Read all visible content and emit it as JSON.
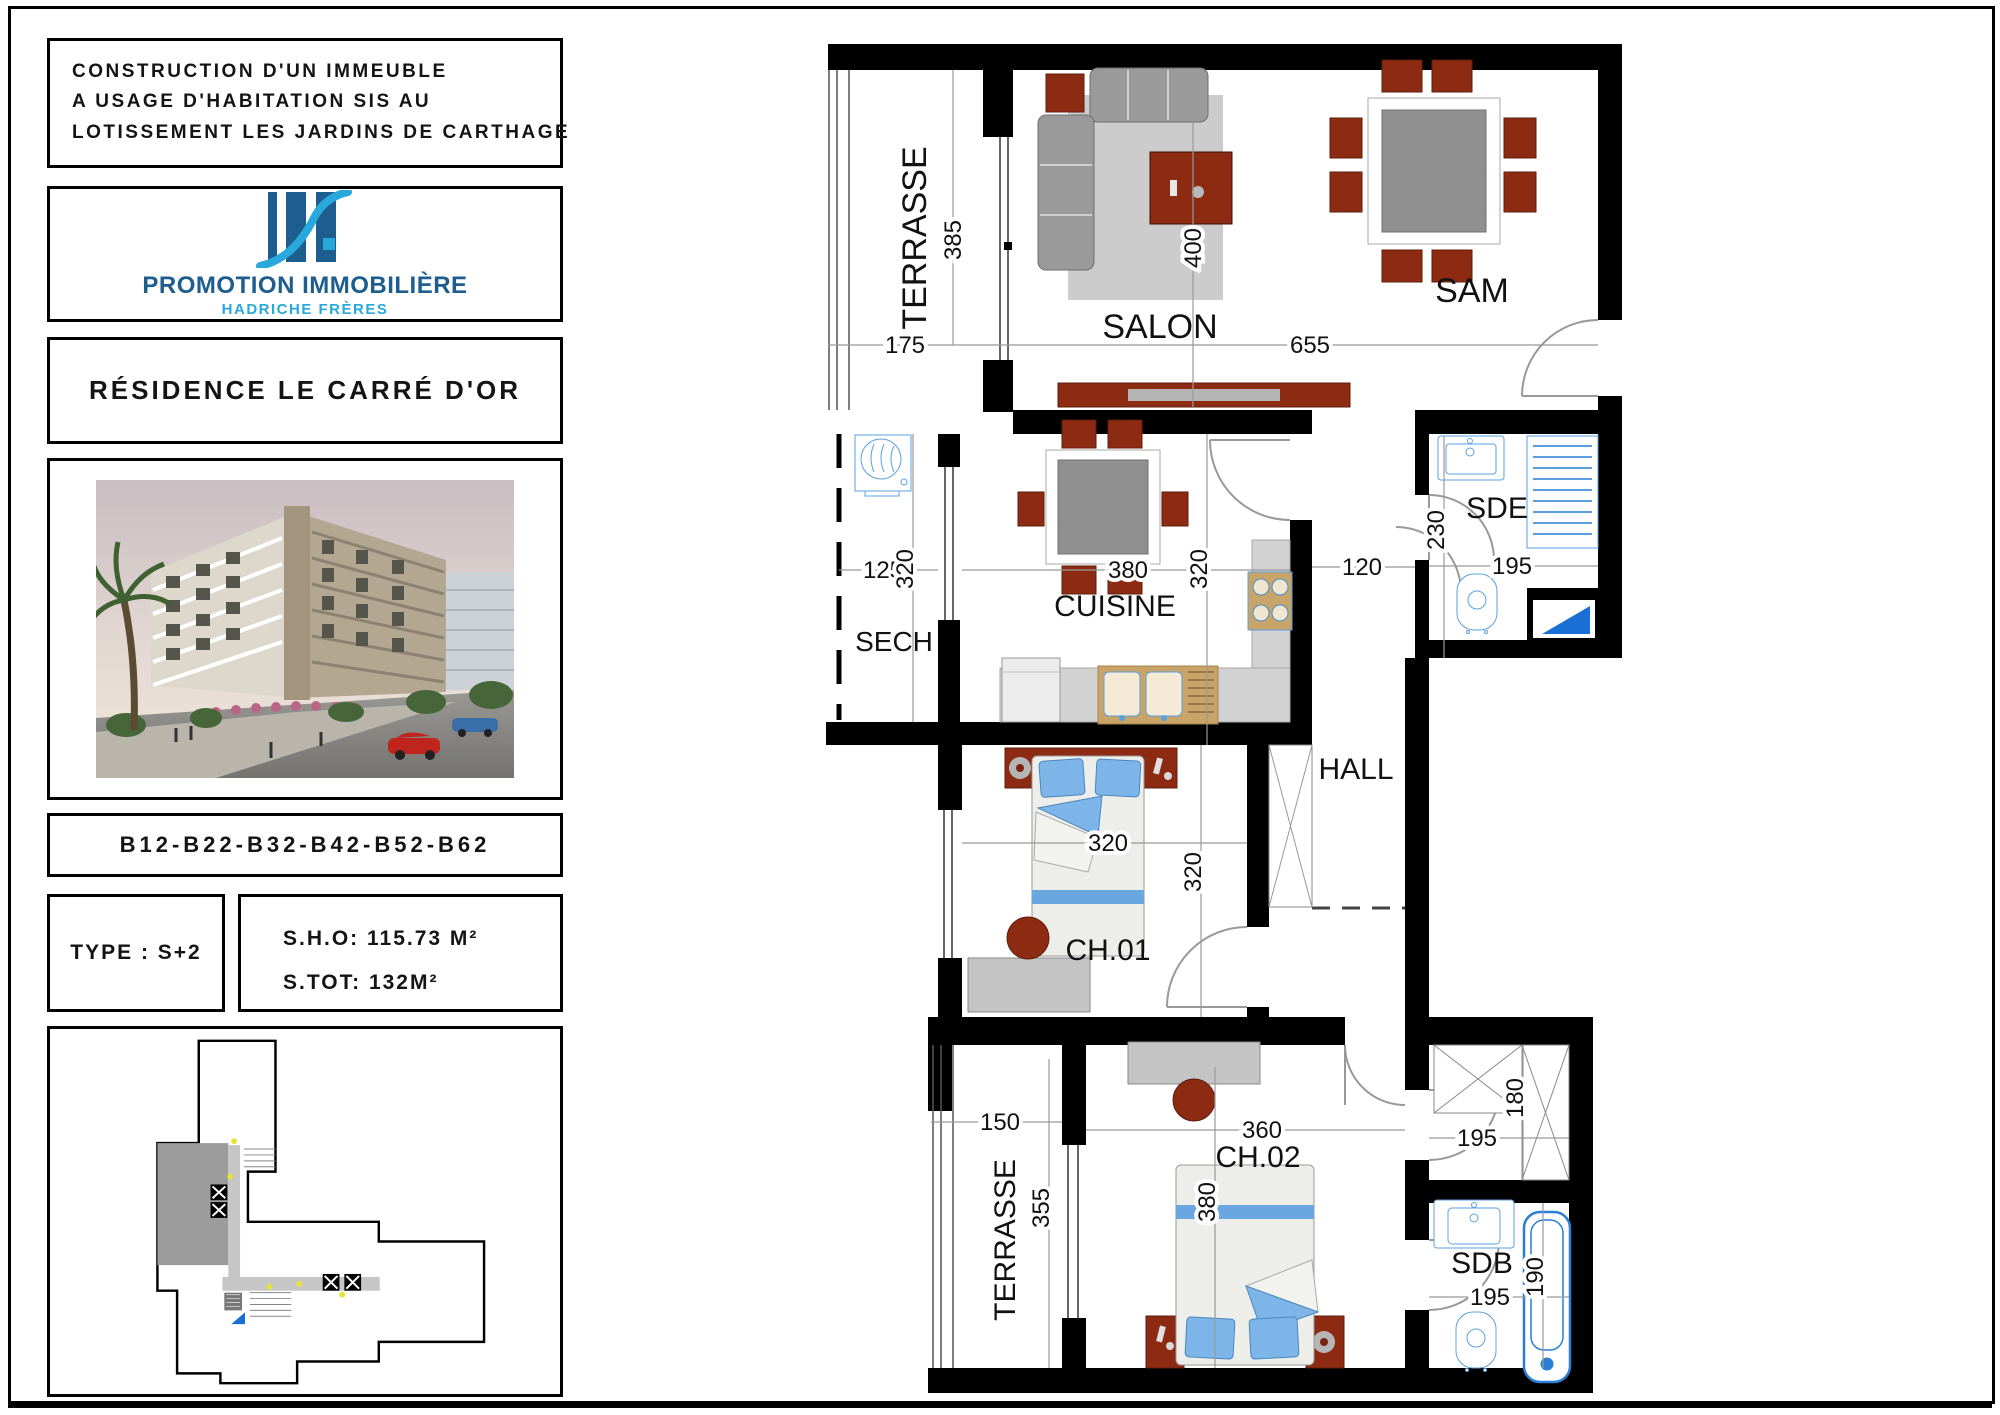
{
  "panel": {
    "project_lines": [
      "CONSTRUCTION D'UN IMMEUBLE",
      "A USAGE D'HABITATION SIS AU",
      "LOTISSEMENT LES JARDINS DE CARTHAGE"
    ],
    "logo": {
      "company": "PROMOTION IMMOBILIÈRE",
      "subtitle": "HADRICHE FRÈRES",
      "bar_color": "#1d5e8e",
      "accent_color": "#29a8dc"
    },
    "residence": "RÉSIDENCE LE CARRÉ D'OR",
    "units": "B12-B22-B32-B42-B52-B62",
    "type": "TYPE : S+2",
    "sho": "S.H.O: 115.73 M²",
    "stot": "S.TOT: 132M²"
  },
  "plan": {
    "rooms": [
      {
        "label": "TERRASSE"
      },
      {
        "label": "SALON"
      },
      {
        "label": "SAM"
      },
      {
        "label": "SECH"
      },
      {
        "label": "CUISINE"
      },
      {
        "label": "SDE"
      },
      {
        "label": "HALL"
      },
      {
        "label": "CH.01"
      },
      {
        "label": "CH.02"
      },
      {
        "label": "TERRASSE"
      },
      {
        "label": "SDB"
      }
    ],
    "dims": {
      "terrace_top_h": "385",
      "terrace_top_w": "175",
      "salon_sam_w": "655",
      "salon_d": "400",
      "sech_w": "125",
      "sech_h": "320",
      "cuisine_w": "380",
      "cuisine_h": "320",
      "entry_w": "120",
      "sde_h": "230",
      "sde_w": "195",
      "ch01_w": "320",
      "ch01_h": "320",
      "terrace_b_w": "150",
      "terrace_b_h": "355",
      "ch02_w": "360",
      "ch02_h": "380",
      "dressing_w": "195",
      "dressing_h": "180",
      "sdb_w": "195",
      "sdb_h": "190"
    },
    "colors": {
      "wall": "#000000",
      "furniture_red": "#8c2a12",
      "furniture_gray": "#9a9a9a",
      "fixture_blue": "#5aa0e0",
      "counter": "#d2d2d2",
      "wood": "#c8a468",
      "rug": "#cccccc",
      "pillow": "#7db5e8",
      "triangle_blue": "#1a6fd4"
    }
  }
}
